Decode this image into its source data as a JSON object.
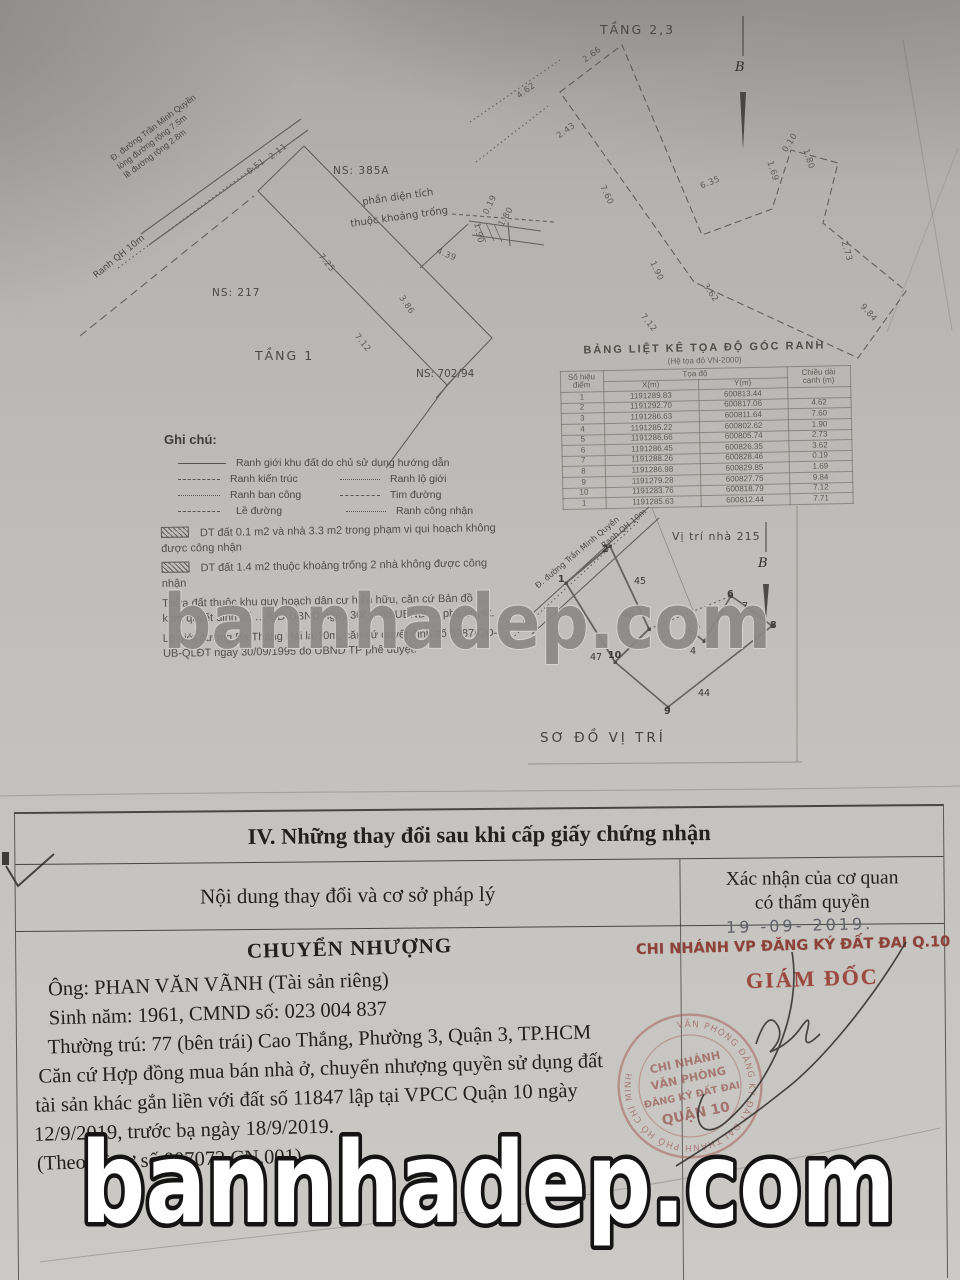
{
  "plan": {
    "tang1_label": "TẦNG 1",
    "tang23_label": "TẦNG 2,3",
    "ns_385a": "NS: 385A",
    "khoang_trong_1": "phần diện tích",
    "khoang_trong_2": "thuộc khoảng trống",
    "ns_217": "NS: 217",
    "ns_70294": "NS: 702/94",
    "street_line1": "Đ. đường Trần Minh Quyền",
    "street_line2": "lòng đường rộng 7.5m",
    "street_line3": "lề đường rộng 2.8m",
    "ranh_qh": "Ranh QH 10m",
    "north_letter": "B",
    "labels": [
      {
        "t": "0.51",
        "x": 246,
        "y": 162,
        "r": -38
      },
      {
        "t": "2.11",
        "x": 268,
        "y": 147,
        "r": -38
      },
      {
        "t": "7.25",
        "x": 316,
        "y": 258,
        "r": 51
      },
      {
        "t": "7.12",
        "x": 352,
        "y": 338,
        "r": 51
      },
      {
        "t": "3.86",
        "x": 396,
        "y": 300,
        "r": 56
      },
      {
        "t": "4.39",
        "x": 436,
        "y": 250,
        "r": 22
      },
      {
        "t": "1.90",
        "x": 468,
        "y": 228,
        "r": 78
      },
      {
        "t": "0.19",
        "x": 480,
        "y": 200,
        "r": -65
      },
      {
        "t": "1.80",
        "x": 496,
        "y": 212,
        "r": -60
      },
      {
        "t": "4.62",
        "x": 516,
        "y": 86,
        "r": -36
      },
      {
        "t": "2.66",
        "x": 582,
        "y": 50,
        "r": -36
      },
      {
        "t": "2.43",
        "x": 556,
        "y": 126,
        "r": -36
      },
      {
        "t": "7.60",
        "x": 596,
        "y": 190,
        "r": 64
      },
      {
        "t": "1.90",
        "x": 646,
        "y": 266,
        "r": 64
      },
      {
        "t": "6.35",
        "x": 700,
        "y": 178,
        "r": -22
      },
      {
        "t": "1.69",
        "x": 762,
        "y": 166,
        "r": 72
      },
      {
        "t": "0.10",
        "x": 780,
        "y": 138,
        "r": -58
      },
      {
        "t": "1.80",
        "x": 798,
        "y": 154,
        "r": 72
      },
      {
        "t": "3.62",
        "x": 700,
        "y": 288,
        "r": 56
      },
      {
        "t": "7.12",
        "x": 638,
        "y": 318,
        "r": 51
      },
      {
        "t": "2.73",
        "x": 836,
        "y": 246,
        "r": 74
      },
      {
        "t": "9.84",
        "x": 858,
        "y": 308,
        "r": 48
      }
    ]
  },
  "coord_table": {
    "title": "BẢNG LIỆT KÊ TỌA ĐỘ GÓC RANH",
    "subtitle": "(Hệ tọa độ VN-2000)",
    "h_point_1": "Số hiệu",
    "h_point_2": "điểm",
    "h_coords": "Tọa độ",
    "h_x": "X(m)",
    "h_y": "Y(m)",
    "h_len_1": "Chiều dài",
    "h_len_2": "cạnh (m)",
    "rows": [
      [
        "1",
        "1191289.83",
        "600813.44",
        ""
      ],
      [
        "2",
        "1191292.70",
        "600817.06",
        "4.62"
      ],
      [
        "3",
        "1191286.63",
        "600811.64",
        "7.60"
      ],
      [
        "4",
        "1191285.22",
        "600802.62",
        "1.90"
      ],
      [
        "5",
        "1191286.66",
        "600805.74",
        "2.73"
      ],
      [
        "6",
        "1191286.45",
        "600826.35",
        "3.62"
      ],
      [
        "7",
        "1191288.26",
        "600828.46",
        "0.19"
      ],
      [
        "8",
        "1191286.98",
        "600829.85",
        "1.69"
      ],
      [
        "9",
        "1191279.28",
        "600827.75",
        "9.84"
      ],
      [
        "10",
        "1191283.76",
        "600818.79",
        "7.12"
      ],
      [
        "1",
        "1191285.63",
        "600812.44",
        "7.71"
      ]
    ]
  },
  "legend": {
    "title": "Ghi chú:",
    "row1": "Ranh giới khu đất do chủ sử dụng hướng dẫn",
    "kien_truc": "Ranh kiến trúc",
    "lo_gioi": "Ranh lộ giới",
    "ban_cong": "Ranh ban công",
    "tim_duong": "Tim đường",
    "le_duong": "Lề đường",
    "cong_nhan": "Ranh công nhận"
  },
  "notes": {
    "n1": "DT đất 0.1 m2 và nhà 3.3 m2 trong phạm vi qui hoạch không được công nhận",
    "n2": "DT đất 1.4 m2 thuộc khoảng trống 2 nhà không được công nhận",
    "n3": "Thửa đất thuộc khu quy hoạch dân cư hiện hữu, căn cứ Bản đồ … kèm quyết định số …/QĐ-UBND ngày 30/… do UBND … phê duyệt.",
    "n4": "Lộ giới đường Ba Tháng Hai là 10m, căn cứ quyết định số 6987/QĐ-UB-QLĐT ngày 30/09/1995 do UBND TP phê duyệt."
  },
  "site_map": {
    "title": "SƠ ĐỒ VỊ TRÍ",
    "vi_tri": "Vị trí nhà 215",
    "street": "Đ. đường Trần Minh Quyền",
    "ranh": "Ranh QH 10m",
    "north_letter": "B",
    "points": [
      {
        "t": "1",
        "x": 558,
        "y": 574,
        "b": 1
      },
      {
        "t": "2",
        "x": 602,
        "y": 544,
        "b": 1
      },
      {
        "t": "45",
        "x": 634,
        "y": 576
      },
      {
        "t": "46",
        "x": 622,
        "y": 610
      },
      {
        "t": "47",
        "x": 590,
        "y": 652
      },
      {
        "t": "10",
        "x": 608,
        "y": 650,
        "b": 1
      },
      {
        "t": "9",
        "x": 664,
        "y": 706,
        "b": 1
      },
      {
        "t": "44",
        "x": 698,
        "y": 688
      },
      {
        "t": "4",
        "x": 690,
        "y": 646
      },
      {
        "t": "6",
        "x": 727,
        "y": 589,
        "b": 1
      },
      {
        "t": "7",
        "x": 742,
        "y": 601
      },
      {
        "t": "8",
        "x": 770,
        "y": 620,
        "b": 1
      }
    ]
  },
  "section4": {
    "title": "IV. Những thay đổi sau khi cấp giấy chứng nhận",
    "col_left": "Nội dung thay đổi và cơ sở pháp lý",
    "col_right_1": "Xác nhận của cơ quan",
    "col_right_2": "có thẩm quyền",
    "date_stamp": "19 -09- 2019.",
    "branch_line": "CHI NHÁNH VP ĐĂNG KÝ ĐẤT ĐAI Q.10",
    "director": "GIÁM ĐỐC",
    "body_heading": "CHUYỂN NHƯỢNG",
    "body_lines": [
      "Ông: PHAN VĂN VÃNH (Tài sản riêng)",
      "Sinh năm: 1961, CMND số: 023 004 837",
      "Thường trú: 77 (bên trái) Cao Thắng, Phường 3, Quận 3, TP.HCM",
      "Căn cứ Hợp đồng mua bán nhà ở, chuyển nhượng quyền sử dụng đất",
      "tài sản khác gắn liền với đất số 11847 lập tại VPCC Quận 10 ngày",
      "12/9/2019, trước bạ ngày 18/9/2019.",
      "(Theo hồ sơ số 007072.CN.001)"
    ],
    "stamp": {
      "ring_text": "VĂN PHÒNG ĐĂNG KÝ ĐẤT ĐAI THÀNH PHỐ HỒ CHÍ MINH",
      "line1": "CHI NHÁNH",
      "line2": "VĂN PHÒNG",
      "line3": "ĐĂNG KÝ ĐẤT ĐAI",
      "line4": "QUẬN 10"
    }
  },
  "watermark": {
    "text": "bannhadep.com"
  },
  "colors": {
    "stamp_red": "#9c4a40",
    "stamp_ring": "#a8655f",
    "date_gray": "#5f636b",
    "draw_line": "#54524e",
    "ink": "#23211e"
  }
}
